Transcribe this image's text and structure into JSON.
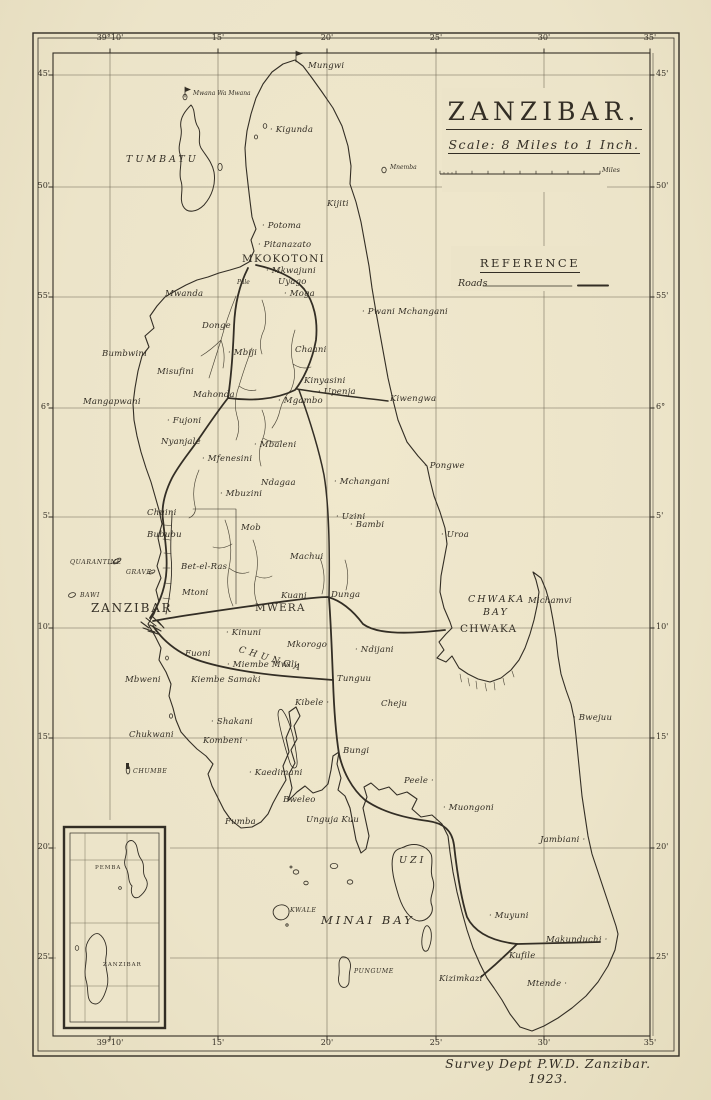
{
  "map": {
    "title": "ZANZIBAR.",
    "scale_text": "Scale: 8 Miles to 1 Inch.",
    "scale_miles_label": "Miles",
    "reference_title": "REFERENCE",
    "reference_roads_label": "Roads",
    "attribution": "Survey Dept P.W.D. Zanzibar. 1923.",
    "colors": {
      "paper": "#ece4c9",
      "ink": "#332e25",
      "grid": "#6e6754"
    }
  },
  "grid": {
    "frame": {
      "x1": 53,
      "y1": 53,
      "x2": 650,
      "y2": 1036
    },
    "vlines": [
      {
        "x": 110,
        "label": "39°10'"
      },
      {
        "x": 218,
        "label": "15'"
      },
      {
        "x": 327,
        "label": "20'"
      },
      {
        "x": 436,
        "label": "25'"
      },
      {
        "x": 544,
        "label": "30'"
      },
      {
        "x": 650,
        "label": "35'"
      }
    ],
    "hlines": [
      {
        "y": 75,
        "label": "45'"
      },
      {
        "y": 187,
        "label": "50'"
      },
      {
        "y": 297,
        "label": "55'"
      },
      {
        "y": 408,
        "label": "6°"
      },
      {
        "y": 517,
        "label": "5'"
      },
      {
        "y": 628,
        "label": "10'"
      },
      {
        "y": 738,
        "label": "15'"
      },
      {
        "y": 848,
        "label": "20'"
      },
      {
        "y": 958,
        "label": "25'"
      }
    ]
  },
  "masks": [
    {
      "x": 442,
      "y": 88,
      "w": 165,
      "h": 104
    },
    {
      "x": 451,
      "y": 246,
      "w": 195,
      "h": 45
    },
    {
      "x": 56,
      "y": 820,
      "w": 114,
      "h": 216
    }
  ],
  "scalebar": {
    "x1": 440,
    "x2": 600,
    "y": 174
  },
  "paths": [
    {
      "n": "stream-donge",
      "d": "M236,296 Q227,318 221,340 Q214,362 209,378 M221,340 Q211,350 201,356 M221,340 Q226,354 223,368",
      "w": 0.65,
      "c": "#4a4436"
    },
    {
      "n": "stream-mahonda",
      "d": "M252,348 Q245,366 239,386 Q233,402 237,416 Q241,428 236,440 M239,386 Q247,392 256,390",
      "w": 0.65,
      "c": "#4a4436"
    },
    {
      "n": "stream-chaani",
      "d": "M295,330 Q289,348 293,364 Q297,376 291,390 M293,364 Q302,370 311,367 M291,390 Q283,398 280,410 Q278,420 272,428",
      "w": 0.65,
      "c": "#4a4436"
    },
    {
      "n": "stream-kinyasini",
      "d": "M262,410 Q268,424 263,438 Q257,452 261,466 M263,438 Q273,444 281,441",
      "w": 0.65,
      "c": "#4a4436"
    },
    {
      "n": "stream-north",
      "d": "M262,300 Q268,316 264,330 Q258,342 262,354",
      "w": 0.65,
      "c": "#4a4436"
    },
    {
      "n": "stream-mwera",
      "d": "M225,520 Q234,544 229,568 Q225,588 233,606 M229,568 Q239,576 249,572 M232,544 Q222,550 213,547",
      "w": 0.65,
      "c": "#4a4436"
    },
    {
      "n": "stream-mwera-east",
      "d": "M253,540 Q260,558 256,576 Q252,592 258,606 M256,576 Q265,580 272,576",
      "w": 0.65,
      "c": "#4a4436"
    },
    {
      "n": "stream-bububu",
      "d": "M199,470 Q191,488 195,506 Q197,514 189,518",
      "w": 0.65,
      "c": "#4a4436"
    },
    {
      "n": "stream-dunga",
      "d": "M320,558 Q327,576 322,594 M345,560 Q350,575 346,590",
      "w": 0.65,
      "c": "#4a4436"
    },
    {
      "n": "mangrove-chwaka",
      "d": "M460,674 l1.5,8 M468,678 l1.5,8 M476,681 l1,8 M485,683 l1.5,8 M494,682 l1,8 M503,678 l1.5,7 M512,671 l2,6",
      "w": 0.6,
      "c": "#4a4436"
    },
    {
      "n": "coast-main",
      "d": "M295,60 L303,66 L312,78 L322,92 L333,108 L342,126 L348,146 L351,166 L350,184 L356,202 L361,222 L365,244 L369,266 L372,288 L376,312 L380,334 L384,356 L388,378 L393,400 L398,420 L407,442 L418,456 L427,466 L430,480 L434,496 L440,512 L445,528 L447,544 L444,560 L441,576 L440,592 L444,608 L450,622 L452,628 L446,634 L439,642 L444,650 L437,658 L446,662 L452,656 L459,668 L468,674 L478,679 L490,682 L501,678 L511,670 L519,660 L525,648 L530,634 L534,620 L537,606 L539,592 L536,580 L533,572 L541,578 L546,590 L550,604 L553,620 L556,638 L558,656 L561,674 L566,690 L571,704 L574,718 L576,736 L578,756 L580,776 L582,796 L585,816 L588,836 L592,854 L598,872 L604,890 L610,908 L616,926 L618,934 L615,950 L608,966 L598,982 L586,996 L572,1008 L558,1018 L544,1026 L532,1031 L520,1027 L510,1014 L502,1000 L494,988 L487,978 L480,964 L473,948 L467,930 L462,912 L457,892 L453,872 L450,852 L448,836 L442,824 L432,815 L421,817 L412,809 L417,799 L407,792 L397,795 L389,787 L379,790 L371,783 L364,787 L367,797 L363,808 L366,822 L369,836 L366,849 L361,853 L356,840 L353,824 L350,808 L345,796 L338,790 L341,778 L337,764 L339,752 L333,756 L331,770 L328,784 L322,790 L313,793 L305,786 L297,792 L288,801 L292,788 L289,774 L295,763 L291,750 L297,739 L294,726 L300,716 L296,707 L289,712 L291,726 L286,738 L289,752 L283,766 L286,780 L279,792 L273,803 L268,814 L261,822 L252,827 L241,828 L231,820 L224,810 L218,798 L212,786 L208,774 L213,764 L206,756 L197,749 L189,741 L181,732 L176,720 L173,708 L169,696 L171,684 L166,672 L159,660 L161,648 L155,636 L148,624 L154,614 L159,602 L156,590 L161,578 L157,566 L161,552 L158,538 L162,524 L159,510 L155,496 L151,482 L146,468 L141,452 L137,436 L134,420 L133,404 L135,388 L138,371 L142,356 L149,347 L145,336 L154,328 L150,316 L157,306 L165,297 L175,291 L186,285 L197,280 L208,277 L219,273 L230,270 L240,267 L249,262 L254,251 L251,240 L256,229 L252,217 L250,201 L248,184 L246,166 L245,148 L247,131 L251,114 L256,98 L263,84 L272,72 L283,64 Z",
      "w": 1.1
    },
    {
      "n": "island-tumbatu",
      "d": "M191,105 C196,110 193,120 198,127 C202,133 197,141 201,148 C206,156 212,162 214,172 C216,184 212,196 204,205 C197,212 187,214 183,206 C179,198 184,190 181,181 C178,172 183,163 180,154 C177,145 183,137 181,128 C179,118 186,110 191,105 Z",
      "w": 1
    },
    {
      "n": "island-uzi",
      "d": "M404,847 C414,842 426,845 431,854 C434,862 429,870 433,880 C436,890 428,897 432,906 C434,914 427,921 419,921 C410,920 403,909 399,897 C395,884 390,868 393,856 C395,849 399,849 404,847 Z",
      "w": 1
    },
    {
      "n": "island-uzi-tail",
      "d": "M428,926 C433,930 432,942 428,950 C424,954 421,948 422,938 C423,931 425,924 428,926 Z",
      "w": 0.9
    },
    {
      "n": "island-kwale",
      "d": "M277,906 C283,903 290,906 289,913 C288,919 281,922 276,918 C272,914 272,909 277,906 Z",
      "w": 0.9
    },
    {
      "n": "island-pungume",
      "d": "M342,957 C348,956 352,962 350,970 C348,978 351,984 346,987 C341,989 337,983 339,975 C340,967 337,961 342,957 Z",
      "w": 0.9
    },
    {
      "n": "creek-island",
      "d": "M283,711 C289,719 295,739 297,760 C298,769 293,771 290,763 C284,745 279,725 278,715 C278,709 281,708 283,711 Z",
      "w": 0.8
    },
    {
      "n": "islet-leader-lines",
      "d": "M109,564 l8,-2 M146,574 l7,-1.5",
      "w": 0.5
    },
    {
      "n": "railway-line",
      "d": "M166,614 C170,596 173,576 171,556 C170,540 172,524 172,512",
      "w": 0.9
    },
    {
      "n": "railway-ticks",
      "d": "M163,598 l7,1 M164,583 l7,0.5 M163,568 l7,0 M164,553 l7,0.5 M163,539 l7,1 M164,525 l7,0.5",
      "w": 0.6
    },
    {
      "n": "estate-boundary",
      "d": "M193,509 L236,509 L236,604",
      "w": 0.6
    },
    {
      "n": "road-north",
      "d": "M150,618 C158,606 164,592 166,576 C168,558 165,540 163,520 C161,505 166,490 172,478 C180,463 190,452 198,440 C207,427 217,412 228,398 C231,378 233,352 234,326 C235,304 239,286 248,268",
      "w": 1.8
    },
    {
      "n": "road-mkokotoni-loop",
      "d": "M228,398 C250,401 275,400 295,390 C303,380 312,362 316,340 C318,320 314,302 304,289 C294,277 275,269 256,265",
      "w": 1.8
    },
    {
      "n": "road-kiwengwa",
      "d": "M297,389 C320,393 355,397 388,401",
      "w": 1.5
    },
    {
      "n": "road-middle",
      "d": "M299,390 C308,415 318,445 324,475 C329,505 330,545 329,598",
      "w": 1.5
    },
    {
      "n": "road-town-chwaka",
      "d": "M153,621 C185,615 230,609 272,603 C295,600 315,597 328,597 C342,601 354,612 363,624 C375,633 400,635 445,630",
      "w": 1.8
    },
    {
      "n": "road-tunguu-south",
      "d": "M329,598 C331,625 332,655 333,680 C334,710 336,735 339,754 C343,772 352,789 365,800 C382,812 405,818 428,821 C443,823 452,830 454,845 C457,872 461,898 467,917 C474,931 490,941 517,944",
      "w": 1.8
    },
    {
      "n": "road-makunduchi",
      "d": "M517,944 L600,942",
      "w": 1.8
    },
    {
      "n": "road-kizimkazi",
      "d": "M517,944 C507,954 494,966 481,977",
      "w": 1.8
    },
    {
      "n": "road-town-tunguu",
      "d": "M153,626 C163,641 176,651 192,658 C215,667 255,674 295,677 L333,680",
      "w": 1.8
    },
    {
      "n": "town-hatch",
      "d": "M141,622 l8,6 M146,618 l10,8 M152,616 l9,9 M143,628 l12,4 M150,625 l11,6 M157,620 l7,8 M148,631 l10,3",
      "w": 1.1
    },
    {
      "n": "lighthouse-flag-pole",
      "d": "M296,62 L296,51",
      "w": 0.8
    },
    {
      "n": "lighthouse-flag-pennant",
      "d": "M296,51 L303,53.5 L296,56 Z",
      "w": 0.4,
      "f": 1
    },
    {
      "n": "mwana-flag-pole",
      "d": "M185,97 L185,87",
      "w": 0.8
    },
    {
      "n": "mwana-flag-pennant",
      "d": "M185,87 L191,89.5 L185,92 Z",
      "w": 0.4,
      "f": 1
    },
    {
      "n": "chumbe-beacon",
      "d": "M126,763 l3,0 l0,6 l-3,0 Z",
      "w": 0.5,
      "f": 1
    },
    {
      "n": "legend-roads-rule",
      "d": "M483,286 L572,286",
      "w": 0.7
    },
    {
      "n": "legend-roads-sample",
      "d": "M578,285.5 L608,285.5",
      "w": 2
    }
  ],
  "islets": [
    {
      "x": 185,
      "y": 97,
      "rx": 2,
      "ry": 2.8
    },
    {
      "x": 265,
      "y": 126,
      "rx": 1.8,
      "ry": 2.4
    },
    {
      "x": 256,
      "y": 137,
      "rx": 1.6,
      "ry": 2
    },
    {
      "x": 220,
      "y": 167,
      "rx": 2.2,
      "ry": 3.6
    },
    {
      "x": 384,
      "y": 170,
      "rx": 2.2,
      "ry": 2.8
    },
    {
      "x": 117,
      "y": 561,
      "rx": 4.6,
      "ry": 1.8,
      "r": -32
    },
    {
      "x": 152,
      "y": 572,
      "rx": 3.2,
      "ry": 1.5,
      "r": -28
    },
    {
      "x": 72,
      "y": 595,
      "rx": 3.6,
      "ry": 2.2,
      "r": -18
    },
    {
      "x": 128,
      "y": 770,
      "rx": 1.8,
      "ry": 4
    },
    {
      "x": 334,
      "y": 866,
      "rx": 3.8,
      "ry": 2.6
    },
    {
      "x": 296,
      "y": 872,
      "rx": 2.8,
      "ry": 2.2
    },
    {
      "x": 306,
      "y": 883,
      "rx": 2.2,
      "ry": 1.8
    },
    {
      "x": 350,
      "y": 882,
      "rx": 2.8,
      "ry": 2.2
    },
    {
      "x": 291,
      "y": 867,
      "rx": 1,
      "ry": 1
    },
    {
      "x": 287,
      "y": 925,
      "rx": 1.2,
      "ry": 1.2
    },
    {
      "x": 171,
      "y": 716,
      "rx": 1.6,
      "ry": 2.2
    },
    {
      "x": 167,
      "y": 658,
      "rx": 1.4,
      "ry": 2
    }
  ],
  "inset": {
    "frame": {
      "x": 64,
      "y": 827,
      "w": 101,
      "h": 201
    },
    "inner": {
      "x": 70,
      "y": 833,
      "w": 89,
      "h": 189
    },
    "vlines": [
      85,
      127
    ],
    "hlines": [
      860,
      923,
      986
    ],
    "paths": [
      {
        "n": "inset-pemba",
        "d": "M133,841 C139,845 136,853 141,859 C146,866 141,872 146,879 C150,886 144,893 139,897 C133,900 130,893 132,886 C127,881 130,874 126,868 C122,861 128,855 126,849 C125,844 129,839 133,841 Z",
        "w": 0.9
      },
      {
        "n": "inset-zanzibar",
        "d": "M99,934 C105,938 108,947 106,957 C104,967 110,976 107,987 C104,998 99,1007 92,1003 C86,999 89,989 86,980 C83,970 88,960 86,951 C85,943 93,931 99,934 Z",
        "w": 0.9
      }
    ],
    "islets": [
      {
        "x": 77,
        "y": 948,
        "rx": 1.8,
        "ry": 2.4
      },
      {
        "x": 120,
        "y": 888,
        "rx": 1.4,
        "ry": 1.4
      }
    ],
    "labels": [
      {
        "t": "PEMBA",
        "x": 95,
        "y": 866,
        "c": "i2"
      },
      {
        "t": "ZANZIBAR",
        "x": 103,
        "y": 963,
        "c": "i2"
      }
    ]
  },
  "labels": [
    {
      "t": "Mungwi",
      "x": 308,
      "y": 62,
      "c": "p"
    },
    {
      "t": "Mwana Wa Mwana",
      "x": 193,
      "y": 91,
      "c": "y"
    },
    {
      "t": "Kigunda",
      "x": 270,
      "y": 126,
      "c": "p",
      "d": 1
    },
    {
      "t": "TUMBATU",
      "x": 126,
      "y": 155,
      "c": "r"
    },
    {
      "t": "Mnemba",
      "x": 390,
      "y": 165,
      "c": "y"
    },
    {
      "t": "Kijiti",
      "x": 327,
      "y": 200,
      "c": "p"
    },
    {
      "t": "Potoma",
      "x": 262,
      "y": 222,
      "c": "p",
      "d": 1
    },
    {
      "t": "Pitanazato",
      "x": 258,
      "y": 241,
      "c": "p",
      "d": 1
    },
    {
      "t": "MKOKOTONI",
      "x": 242,
      "y": 254,
      "c": "t"
    },
    {
      "t": "Mkwajuni",
      "x": 266,
      "y": 267,
      "c": "p",
      "d": 1
    },
    {
      "t": "Uyago",
      "x": 278,
      "y": 278,
      "c": "p"
    },
    {
      "t": "Pale",
      "x": 237,
      "y": 280,
      "c": "y"
    },
    {
      "t": "Moga",
      "x": 284,
      "y": 290,
      "c": "p",
      "d": 1
    },
    {
      "t": "Mwanda",
      "x": 165,
      "y": 290,
      "c": "p"
    },
    {
      "t": "Pwani Mchangani",
      "x": 362,
      "y": 308,
      "c": "p",
      "d": 1
    },
    {
      "t": "Donge",
      "x": 202,
      "y": 322,
      "c": "p"
    },
    {
      "t": "Chaani",
      "x": 295,
      "y": 346,
      "c": "p"
    },
    {
      "t": "Bumbwini",
      "x": 102,
      "y": 350,
      "c": "p"
    },
    {
      "t": "Mbiji",
      "x": 228,
      "y": 349,
      "c": "p",
      "d": 1
    },
    {
      "t": "Misufini",
      "x": 157,
      "y": 368,
      "c": "p"
    },
    {
      "t": "Kinyasini",
      "x": 304,
      "y": 377,
      "c": "p"
    },
    {
      "t": "Upenja",
      "x": 318,
      "y": 388,
      "c": "p",
      "d": 1
    },
    {
      "t": "Mahonda",
      "x": 193,
      "y": 391,
      "c": "p"
    },
    {
      "t": "Mgambo",
      "x": 278,
      "y": 397,
      "c": "p",
      "d": 1
    },
    {
      "t": "Kiwengwa",
      "x": 390,
      "y": 395,
      "c": "p"
    },
    {
      "t": "Mangapwani",
      "x": 83,
      "y": 398,
      "c": "p"
    },
    {
      "t": "Fujoni",
      "x": 167,
      "y": 417,
      "c": "p",
      "d": 1
    },
    {
      "t": "Nyanjale",
      "x": 161,
      "y": 438,
      "c": "p"
    },
    {
      "t": "Mbaleni",
      "x": 254,
      "y": 441,
      "c": "p",
      "d": 1
    },
    {
      "t": "Mfenesini",
      "x": 202,
      "y": 455,
      "c": "p",
      "d": 1
    },
    {
      "t": "Pongwe",
      "x": 424,
      "y": 462,
      "c": "p",
      "d": 1
    },
    {
      "t": "Ndagaa",
      "x": 261,
      "y": 479,
      "c": "p"
    },
    {
      "t": "Mchangani",
      "x": 334,
      "y": 478,
      "c": "p",
      "d": 1
    },
    {
      "t": "Mbuzini",
      "x": 220,
      "y": 490,
      "c": "p",
      "d": 1
    },
    {
      "t": "Chuini",
      "x": 147,
      "y": 509,
      "c": "p"
    },
    {
      "t": "Uzini",
      "x": 336,
      "y": 513,
      "c": "p",
      "d": 1
    },
    {
      "t": "Bambi",
      "x": 350,
      "y": 521,
      "c": "p",
      "d": 1
    },
    {
      "t": "Mob",
      "x": 241,
      "y": 524,
      "c": "p"
    },
    {
      "t": "Bububu",
      "x": 147,
      "y": 531,
      "c": "p"
    },
    {
      "t": "Uroa",
      "x": 441,
      "y": 531,
      "c": "p",
      "d": 1
    },
    {
      "t": "Machui",
      "x": 290,
      "y": 553,
      "c": "p"
    },
    {
      "t": "QUARANTINE",
      "x": 70,
      "y": 560,
      "c": "i"
    },
    {
      "t": "GRAVE",
      "x": 126,
      "y": 570,
      "c": "i"
    },
    {
      "t": "Bet-el-Ras",
      "x": 181,
      "y": 563,
      "c": "p"
    },
    {
      "t": "Mtoni",
      "x": 182,
      "y": 589,
      "c": "p"
    },
    {
      "t": "BAWI",
      "x": 80,
      "y": 593,
      "c": "i"
    },
    {
      "t": "Kuani",
      "x": 281,
      "y": 592,
      "c": "p"
    },
    {
      "t": "Dunga",
      "x": 331,
      "y": 591,
      "c": "p"
    },
    {
      "t": "CHWAKA",
      "x": 468,
      "y": 595,
      "c": "b"
    },
    {
      "t": "BAY",
      "x": 483,
      "y": 608,
      "c": "b"
    },
    {
      "t": "Michamvi",
      "x": 528,
      "y": 597,
      "c": "p"
    },
    {
      "t": "ZANZIBAR",
      "x": 91,
      "y": 602,
      "c": "t2"
    },
    {
      "t": "MWERA",
      "x": 255,
      "y": 603,
      "c": "t"
    },
    {
      "t": "CHWAKA",
      "x": 460,
      "y": 624,
      "c": "t"
    },
    {
      "t": "Kinuni",
      "x": 226,
      "y": 629,
      "c": "p",
      "d": 1
    },
    {
      "t": "CHUNGA",
      "x": 240,
      "y": 646,
      "c": "c",
      "r": 17
    },
    {
      "t": "Mkorogo",
      "x": 287,
      "y": 641,
      "c": "p"
    },
    {
      "t": "Ndijani",
      "x": 355,
      "y": 646,
      "c": "p",
      "d": 1
    },
    {
      "t": "Fuoni",
      "x": 185,
      "y": 650,
      "c": "p"
    },
    {
      "t": "Miembe Mwili",
      "x": 227,
      "y": 661,
      "c": "p",
      "d": 1
    },
    {
      "t": "Kiembe Samaki",
      "x": 191,
      "y": 676,
      "c": "p"
    },
    {
      "t": "Tunguu",
      "x": 337,
      "y": 675,
      "c": "p"
    },
    {
      "t": "Mbweni",
      "x": 125,
      "y": 676,
      "c": "p"
    },
    {
      "t": "Kibele",
      "x": 295,
      "y": 699,
      "c": "p",
      "d": 2
    },
    {
      "t": "Cheju",
      "x": 381,
      "y": 700,
      "c": "p"
    },
    {
      "t": "Bwejuu",
      "x": 573,
      "y": 714,
      "c": "p",
      "d": 1
    },
    {
      "t": "Shakani",
      "x": 211,
      "y": 718,
      "c": "p",
      "d": 1
    },
    {
      "t": "Chukwani",
      "x": 129,
      "y": 731,
      "c": "p"
    },
    {
      "t": "Kombeni",
      "x": 203,
      "y": 737,
      "c": "p",
      "d": 2
    },
    {
      "t": "Bungi",
      "x": 343,
      "y": 747,
      "c": "p"
    },
    {
      "t": "CHUMBE",
      "x": 133,
      "y": 769,
      "c": "i"
    },
    {
      "t": "Kaedimani",
      "x": 249,
      "y": 769,
      "c": "p",
      "d": 1
    },
    {
      "t": "Peele",
      "x": 404,
      "y": 777,
      "c": "p",
      "d": 2
    },
    {
      "t": "Bweleo",
      "x": 283,
      "y": 796,
      "c": "p"
    },
    {
      "t": "Muongoni",
      "x": 443,
      "y": 804,
      "c": "p",
      "d": 1
    },
    {
      "t": "Fumba",
      "x": 225,
      "y": 818,
      "c": "p"
    },
    {
      "t": "Unguja Kuu",
      "x": 306,
      "y": 816,
      "c": "p"
    },
    {
      "t": "Jambiani",
      "x": 540,
      "y": 836,
      "c": "p",
      "d": 2
    },
    {
      "t": "UZI",
      "x": 399,
      "y": 856,
      "c": "r"
    },
    {
      "t": "KWALE",
      "x": 290,
      "y": 908,
      "c": "i"
    },
    {
      "t": "MINAI BAY",
      "x": 321,
      "y": 915,
      "c": "b2"
    },
    {
      "t": "Muyuni",
      "x": 489,
      "y": 912,
      "c": "p",
      "d": 1
    },
    {
      "t": "Makunduchi",
      "x": 546,
      "y": 936,
      "c": "p",
      "d": 2
    },
    {
      "t": "Kufile",
      "x": 509,
      "y": 952,
      "c": "p"
    },
    {
      "t": "PUNGUME",
      "x": 354,
      "y": 969,
      "c": "i"
    },
    {
      "t": "Kizimkazi",
      "x": 439,
      "y": 975,
      "c": "p"
    },
    {
      "t": "Mtende",
      "x": 527,
      "y": 980,
      "c": "p",
      "d": 2
    }
  ]
}
